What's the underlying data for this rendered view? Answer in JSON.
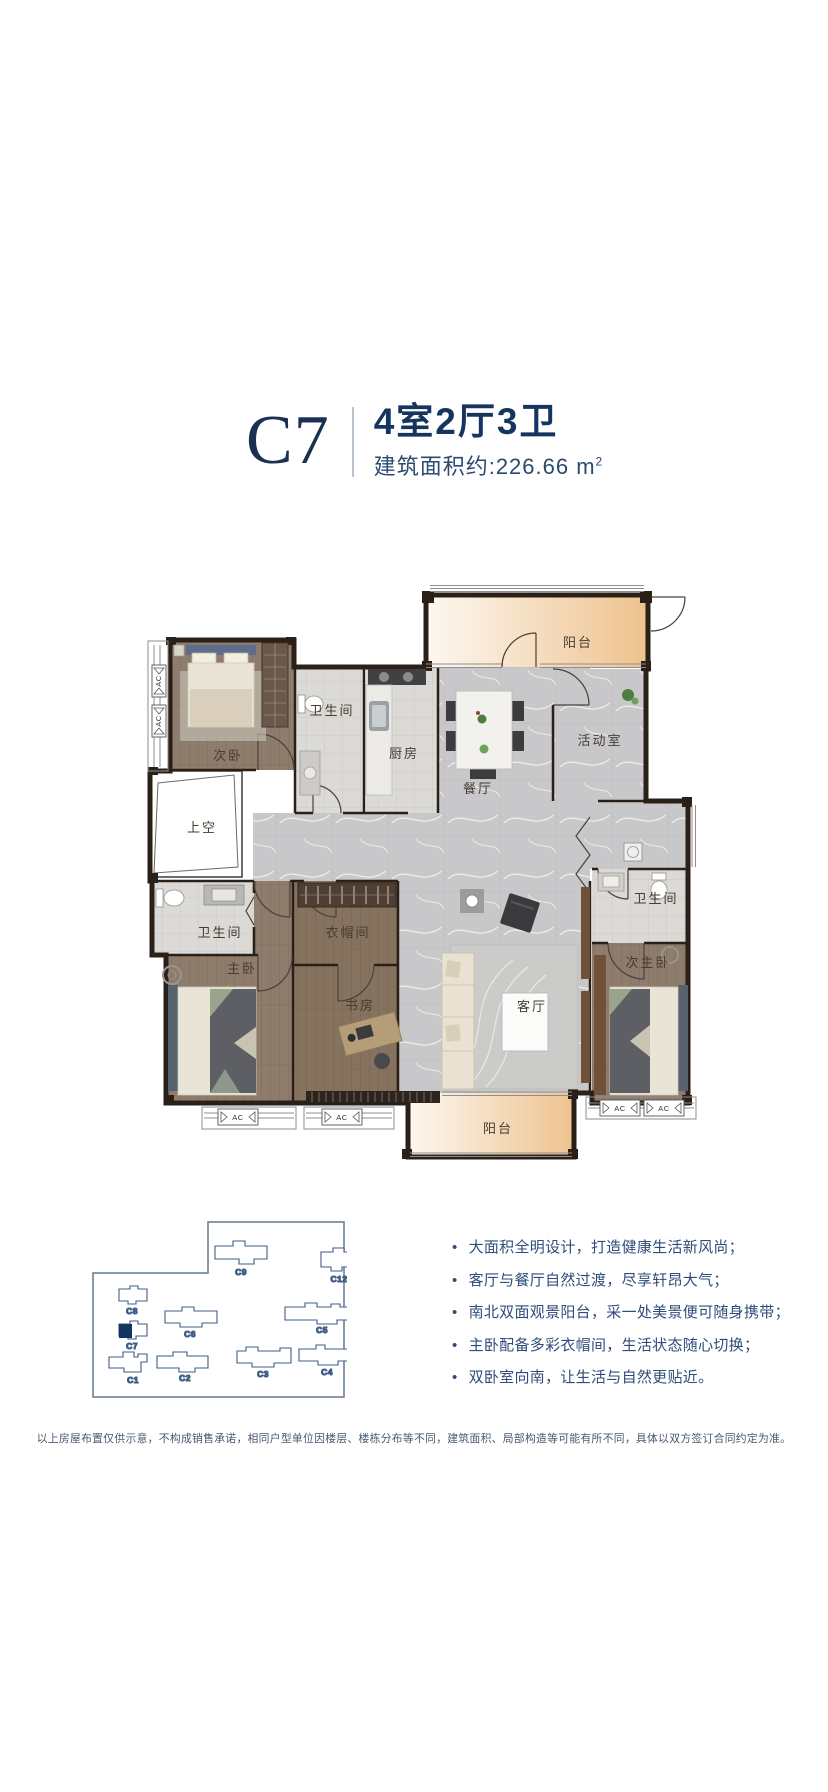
{
  "header": {
    "unit_code": "C7",
    "layout_title": "4室2厅3卫",
    "area_text": "建筑面积约:226.66 m",
    "area_sup": "2"
  },
  "colors": {
    "brand_navy": "#16355e",
    "balcony_peach": "#eec28e",
    "highlight_fill": "#14355f"
  },
  "floor_plan": {
    "rooms": {
      "balcony_top": "阳台",
      "activity_room": "活动室",
      "dining_room": "餐厅",
      "kitchen": "厨房",
      "bathroom_top": "卫生间",
      "bedroom_second": "次卧",
      "void_space": "上空",
      "bathroom_left": "卫生间",
      "master_bedroom": "主卧",
      "cloakroom": "衣帽间",
      "study": "书房",
      "living_room": "客厅",
      "second_master_bedroom": "次主卧",
      "bathroom_right": "卫生间",
      "balcony_bottom": "阳台"
    },
    "ac_label": "AC"
  },
  "site_plan": {
    "highlighted_unit": "C7",
    "buildings": [
      {
        "label": "C9"
      },
      {
        "label": "C12"
      },
      {
        "label": "C8"
      },
      {
        "label": "C6"
      },
      {
        "label": "C5"
      },
      {
        "label": "C7"
      },
      {
        "label": "C1"
      },
      {
        "label": "C2"
      },
      {
        "label": "C3"
      },
      {
        "label": "C4"
      }
    ]
  },
  "features": {
    "items": [
      "大面积全明设计，打造健康生活新风尚；",
      "客厅与餐厅自然过渡，尽享轩昂大气；",
      "南北双面观景阳台，采一处美景便可随身携带；",
      "主卧配备多彩衣帽间，生活状态随心切换；",
      "双卧室向南，让生活与自然更贴近。"
    ]
  },
  "disclaimer": "以上房屋布置仅供示意，不构成销售承诺，相同户型单位因楼层、楼栋分布等不同，建筑面积、局部构造等可能有所不同，具体以双方签订合同约定为准。"
}
